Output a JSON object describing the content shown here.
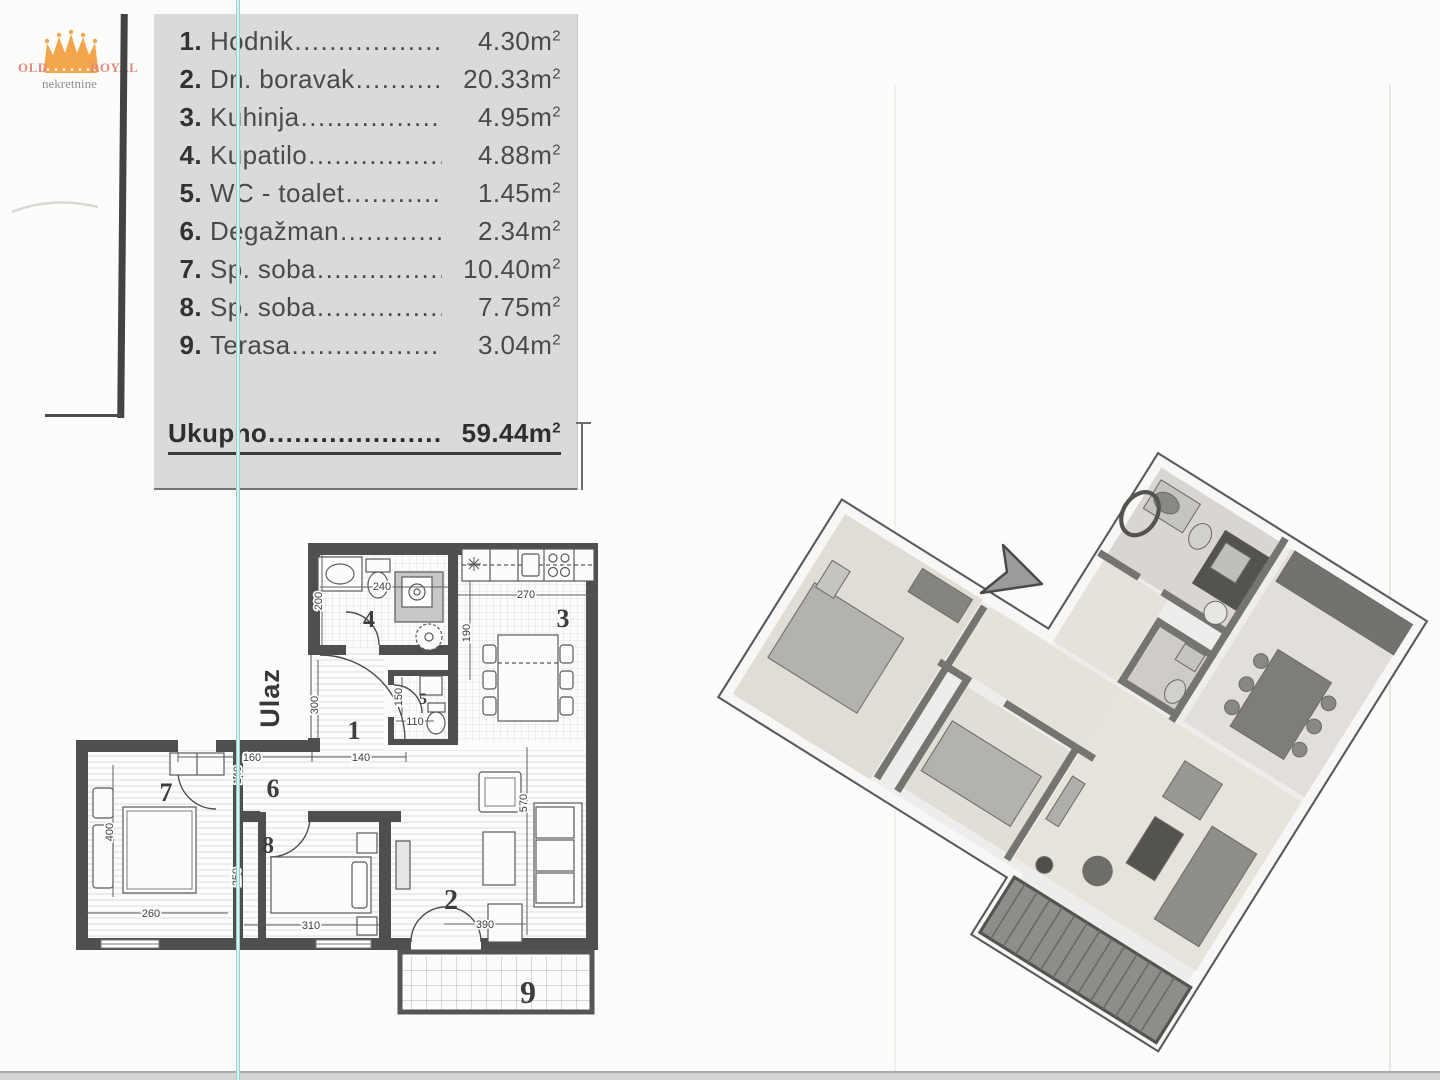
{
  "logo": {
    "left_text": "OLD",
    "right_text": "ROYAL",
    "subtitle": "nekretnine",
    "crown_color": "#f3a54b",
    "text_color": "#e5897c"
  },
  "area_list": {
    "rows": [
      {
        "num": "1.",
        "label": "Hodnik",
        "value": "4.30"
      },
      {
        "num": "2.",
        "label": "Dn. boravak",
        "value": "20.33"
      },
      {
        "num": "3.",
        "label": "Kuhinja",
        "value": "4.95"
      },
      {
        "num": "4.",
        "label": "Kupatilo",
        "value": "4.88"
      },
      {
        "num": "5.",
        "label": "WC - toalet",
        "value": "1.45"
      },
      {
        "num": "6.",
        "label": "Degažman",
        "value": "2.34"
      },
      {
        "num": "7.",
        "label": "Sp. soba",
        "value": "10.40"
      },
      {
        "num": "8.",
        "label": "Sp. soba",
        "value": "7.75"
      },
      {
        "num": "9.",
        "label": "Terasa",
        "value": "3.04"
      }
    ],
    "total": {
      "label": "Ukupno",
      "value": "59.44"
    },
    "unit": "m",
    "sup": "2",
    "leader": "............................................................",
    "panel_color": "#dadada"
  },
  "floor_plan": {
    "entrance_label": "Ulaz",
    "rooms": {
      "r1": "1",
      "r2": "2",
      "r3": "3",
      "r4": "4",
      "r5": "5",
      "r6": "6",
      "r7": "7",
      "r8": "8",
      "r9": "9"
    },
    "dims": {
      "d240": "240",
      "d200": "200",
      "d270": "270",
      "d190": "190",
      "d150": "150",
      "d110": "110",
      "d300": "300",
      "d160": "160",
      "d140a": "140",
      "d140b": "140",
      "d400": "400",
      "d260": "260",
      "d250": "250",
      "d310": "310",
      "d390": "390",
      "d570": "570"
    },
    "wall_color": "#4f4f4f",
    "teal_artifact_color": "#8fd3cd"
  }
}
